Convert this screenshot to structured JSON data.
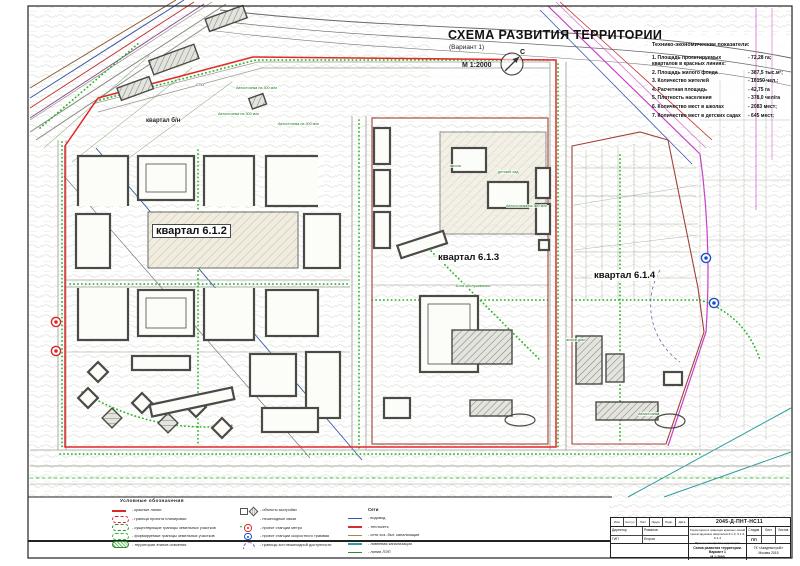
{
  "colors": {
    "red_line": "#e02828",
    "dark_red": "#a04038",
    "green_dotted": "#2ab52a",
    "cadastral_green": "#55883f",
    "magenta": "#c83fc8",
    "blue": "#3558a8",
    "teal": "#2f9e9e",
    "brown": "#8a5a32",
    "building_stroke": "#4a4a46"
  },
  "title": {
    "main": "СХЕМА РАЗВИТИЯ ТЕРРИТОРИИ",
    "variant": "(Вариант 1)",
    "scale": "М 1:2000",
    "north": "С"
  },
  "indicators": {
    "header": "Технико-экономические показатели:",
    "items": [
      {
        "n": "1.",
        "label": "Площадь проектируемых кварталов в красных линиях:",
        "value": "- 72,28 га;"
      },
      {
        "n": "2.",
        "label": "Площадь жилого фонда",
        "value": "- 387,5 тыс.м²;"
      },
      {
        "n": "3.",
        "label": "Количество жителей",
        "value": "- 16150 чел.;"
      },
      {
        "n": "4.",
        "label": "Расчетная площадь",
        "value": "- 42,75 га"
      },
      {
        "n": "5.",
        "label": "Плотность населения",
        "value": "- 378,0 чел/га"
      },
      {
        "n": "6.",
        "label": "Количество мест в школах",
        "value": "- 2083 мест;"
      },
      {
        "n": "7.",
        "label": "Количество мест в детских садах",
        "value": "- 645 мест;"
      }
    ]
  },
  "legend": {
    "header": "Условные обозначения",
    "col1": [
      {
        "symbol": "red-line",
        "label": "- красные линии"
      },
      {
        "symbol": "red-oval-dash",
        "label": "- граница проекта планировки"
      },
      {
        "symbol": "green-oval-dashdot",
        "label": "- существующие границы земельных участков"
      },
      {
        "symbol": "green-oval-dash",
        "label": "- формируемые границы земельных участков"
      },
      {
        "symbol": "green-oval-hatch",
        "label": "- территории этапов освоения"
      }
    ],
    "col2": [
      {
        "symbol": "objects",
        "label": "- объекты застройки"
      },
      {
        "symbol": "green-dots",
        "label": "- пешеходные связи"
      },
      {
        "symbol": "metro",
        "label": "- проект станции метро"
      },
      {
        "symbol": "tram",
        "label": "- проект станции скоростного трамвая"
      },
      {
        "symbol": "arc",
        "label": "- границы зон пешеходной доступности"
      }
    ],
    "col3_header": "Сети",
    "col3": [
      {
        "symbol": "net",
        "color": "#3558a8",
        "label": "- водовод"
      },
      {
        "symbol": "net",
        "color": "#d03030",
        "label": "- теплосеть"
      },
      {
        "symbol": "net",
        "color": "#a08a50",
        "label": "- сети хоз.-быт. канализации"
      },
      {
        "symbol": "net",
        "color": "#2f9e9e",
        "label": "- ливневая канализация"
      },
      {
        "symbol": "net",
        "color": "#2e8a2e",
        "label": "- линии ЛЭП"
      }
    ]
  },
  "map_labels": [
    {
      "text": "квартал 6.1.2",
      "x": 152,
      "y": 224,
      "cls": "quarter boxed"
    },
    {
      "text": "квартал 6.1.3",
      "x": 436,
      "y": 252,
      "cls": "quarter"
    },
    {
      "text": "квартал 6.1.4",
      "x": 592,
      "y": 270,
      "cls": "quarter"
    },
    {
      "text": "квартал б/н",
      "x": 146,
      "y": 118,
      "cls": "small-bold"
    },
    {
      "text": "СТО",
      "x": 196,
      "y": 82,
      "cls": "micro"
    },
    {
      "text": "Автостоянка на 300 м/м",
      "x": 236,
      "y": 86,
      "cls": "micro-green"
    },
    {
      "text": "Автостоянка на 300 м/м",
      "x": 218,
      "y": 112,
      "cls": "micro-green"
    },
    {
      "text": "Автостоянка на 300 м/м",
      "x": 278,
      "y": 122,
      "cls": "micro-green"
    },
    {
      "text": "школа",
      "x": 450,
      "y": 164,
      "cls": "micro-green"
    },
    {
      "text": "детский сад",
      "x": 498,
      "y": 170,
      "cls": "micro-green"
    },
    {
      "text": "Автостоянка на 300 м/м",
      "x": 506,
      "y": 204,
      "cls": "micro-green"
    },
    {
      "text": "Блок обслуживания",
      "x": 456,
      "y": 284,
      "cls": "micro-green"
    },
    {
      "text": "жилой дом",
      "x": 566,
      "y": 338,
      "cls": "micro-green"
    },
    {
      "text": "Автостоянка",
      "x": 638,
      "y": 412,
      "cls": "micro-green"
    }
  ],
  "stamp": {
    "doc_number": "2045-Д-ПНТ-НС11",
    "header_cells": [
      "Изм.",
      "Кол.уч",
      "Лист",
      "№док.",
      "Подп.",
      "Дата"
    ],
    "rows": [
      {
        "role": "Директор",
        "name": "Романов"
      },
      {
        "role": "ГИП",
        "name": "Егоров"
      }
    ],
    "project_lines": [
      "Территория в границах красных линий",
      "проектируемых кварталов 6.1.2, 6.1.3, 6.1.4",
      "Проект планировки территории"
    ],
    "stage_header": [
      "Стадия",
      "Лист",
      "Листов"
    ],
    "stage_value": "ПП",
    "sheet_title_1": "Схема развития территории. Вариант 1",
    "sheet_title_2": "М 1:2000",
    "org_1": "ГК «Академстрой»",
    "org_2": "Москва 2015"
  }
}
